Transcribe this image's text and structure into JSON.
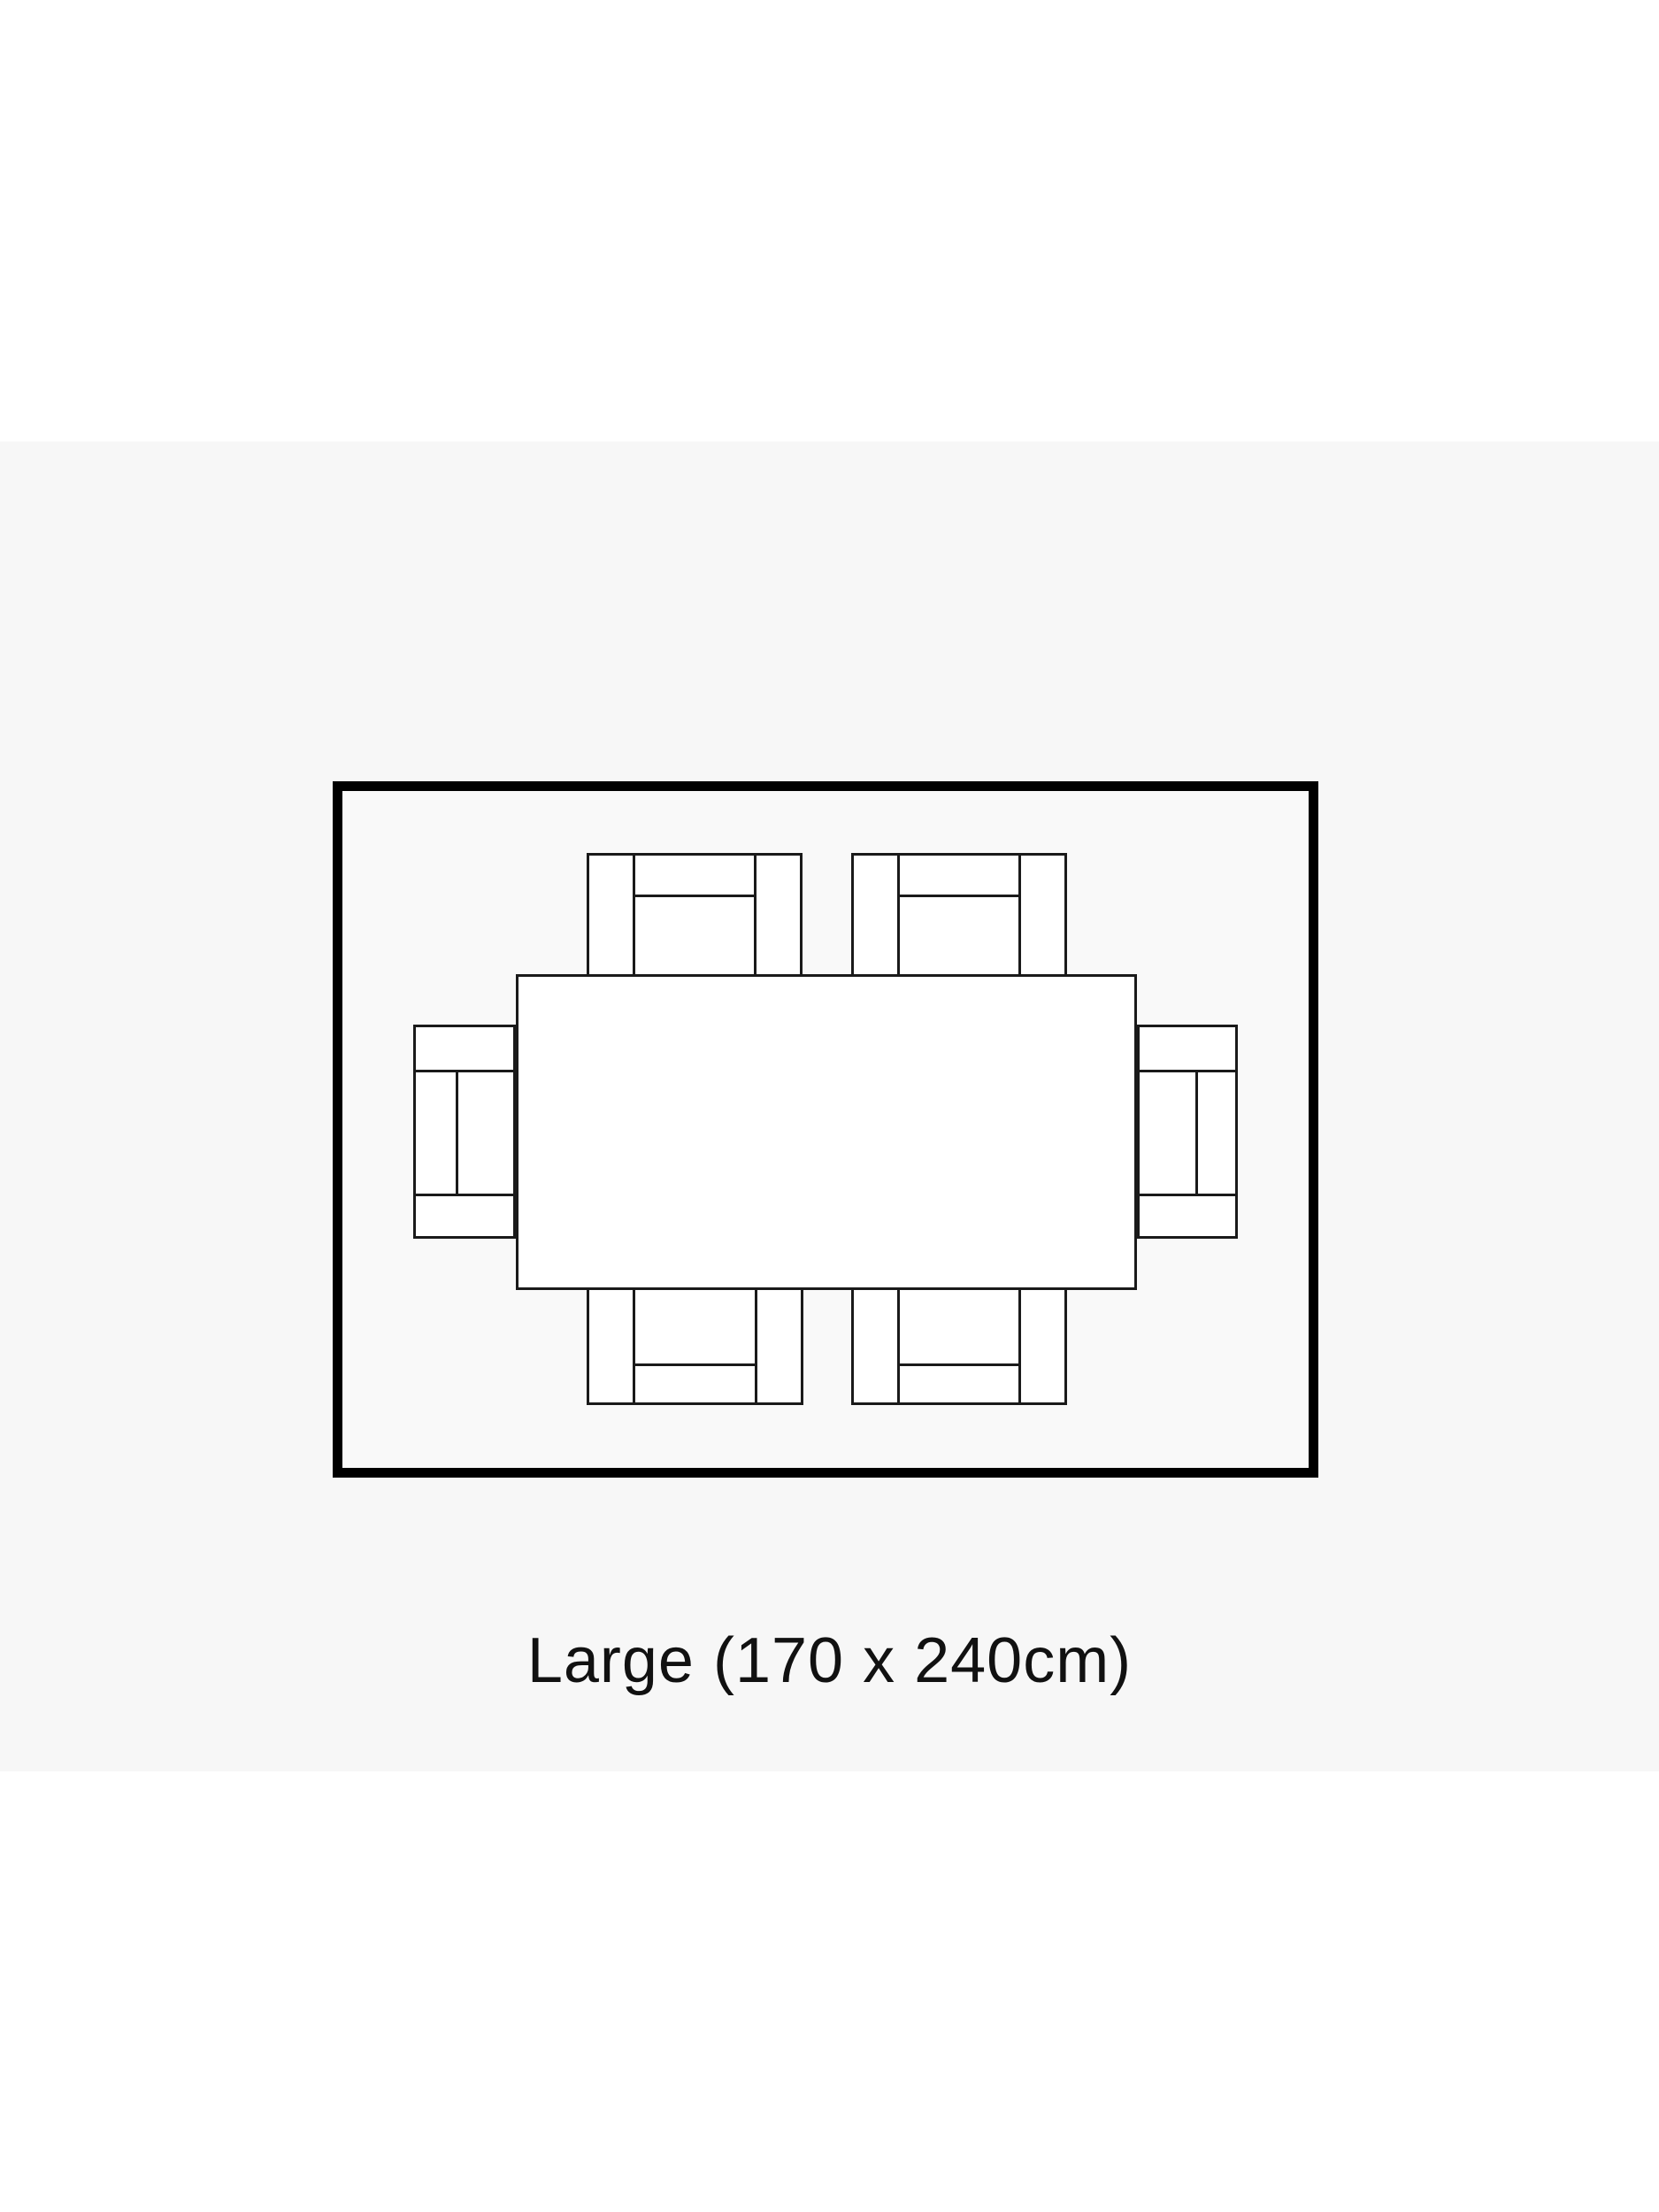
{
  "title": {
    "text": "Example Placement"
  },
  "caption": {
    "text": "Large (170 x 240cm)"
  },
  "diagram": {
    "type": "rug-placement-top-view",
    "chair_count": 6,
    "band_color": "#f7f7f7",
    "rug_fill": "#f9f9f9",
    "rug_border_color": "#000000",
    "furniture_fill": "#ffffff",
    "furniture_stroke": "#1a1a1a",
    "text_color": "#111111"
  }
}
